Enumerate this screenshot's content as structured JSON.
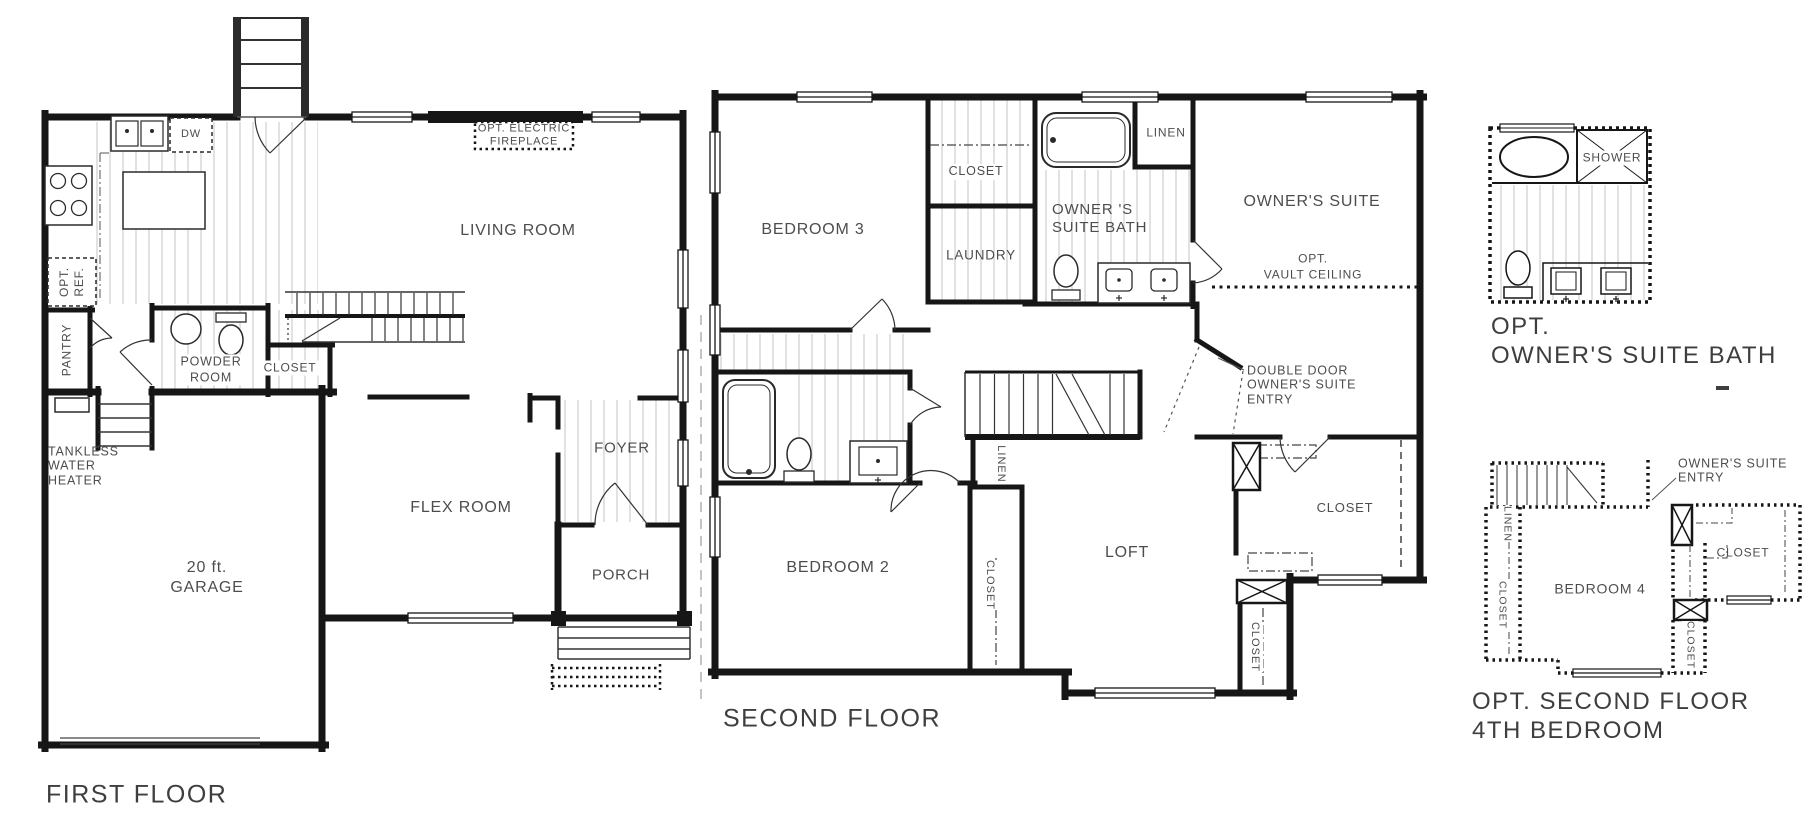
{
  "colors": {
    "wall": "#161616",
    "label": "#4d4d4d",
    "title": "#3e3e3e",
    "hatch": "#c6c6c6"
  },
  "first_floor": {
    "title": "FIRST FLOOR",
    "rooms": {
      "living_room": "LIVING ROOM",
      "flex_room": "FLEX  ROOM",
      "garage": "20 ft.\nGARAGE",
      "foyer": "FOYER",
      "porch": "PORCH",
      "powder_room": "POWDER\nROOM",
      "closet": "CLOSET",
      "pantry": "PANTRY"
    },
    "annotations": {
      "opt_ref": "OPT.\nREF.",
      "tankless": "TANKLESS\nWATER\nHEATER",
      "dishwasher": "DW",
      "fireplace": "OPT. ELECTRIC\nFIREPLACE"
    }
  },
  "second_floor": {
    "title": "SECOND FLOOR",
    "rooms": {
      "bedroom3": "BEDROOM 3",
      "closet_top": "CLOSET",
      "laundry": "LAUNDRY",
      "owners_suite_bath": "OWNER 'S\nSUITE BATH",
      "linen_top": "LINEN",
      "owners_suite": "OWNER'S SUITE",
      "bedroom2": "BEDROOM 2",
      "loft": "LOFT",
      "closet_owners": "CLOSET",
      "closet_bedroom2": "CLOSET",
      "linen_hall": "LINEN",
      "closet_hall": "CLOSET"
    },
    "annotations": {
      "opt_vault": "OPT.\nVAULT CEILING",
      "double_door": "DOUBLE DOOR\nOWNER'S SUITE\nENTRY"
    }
  },
  "opt_owners_bath": {
    "title": "OPT.\nOWNER'S SUITE BATH",
    "labels": {
      "shower": "SHOWER"
    }
  },
  "opt_fourth_bedroom": {
    "title": "OPT. SECOND FLOOR\n4TH BEDROOM",
    "rooms": {
      "bedroom4": "BEDROOM 4",
      "closet_right": "CLOSET",
      "linen": "LINEN",
      "closet_left": "CLOSET",
      "closet_center": "CLOSET"
    },
    "annotations": {
      "owners_entry": "OWNER'S SUITE\nENTRY"
    }
  }
}
